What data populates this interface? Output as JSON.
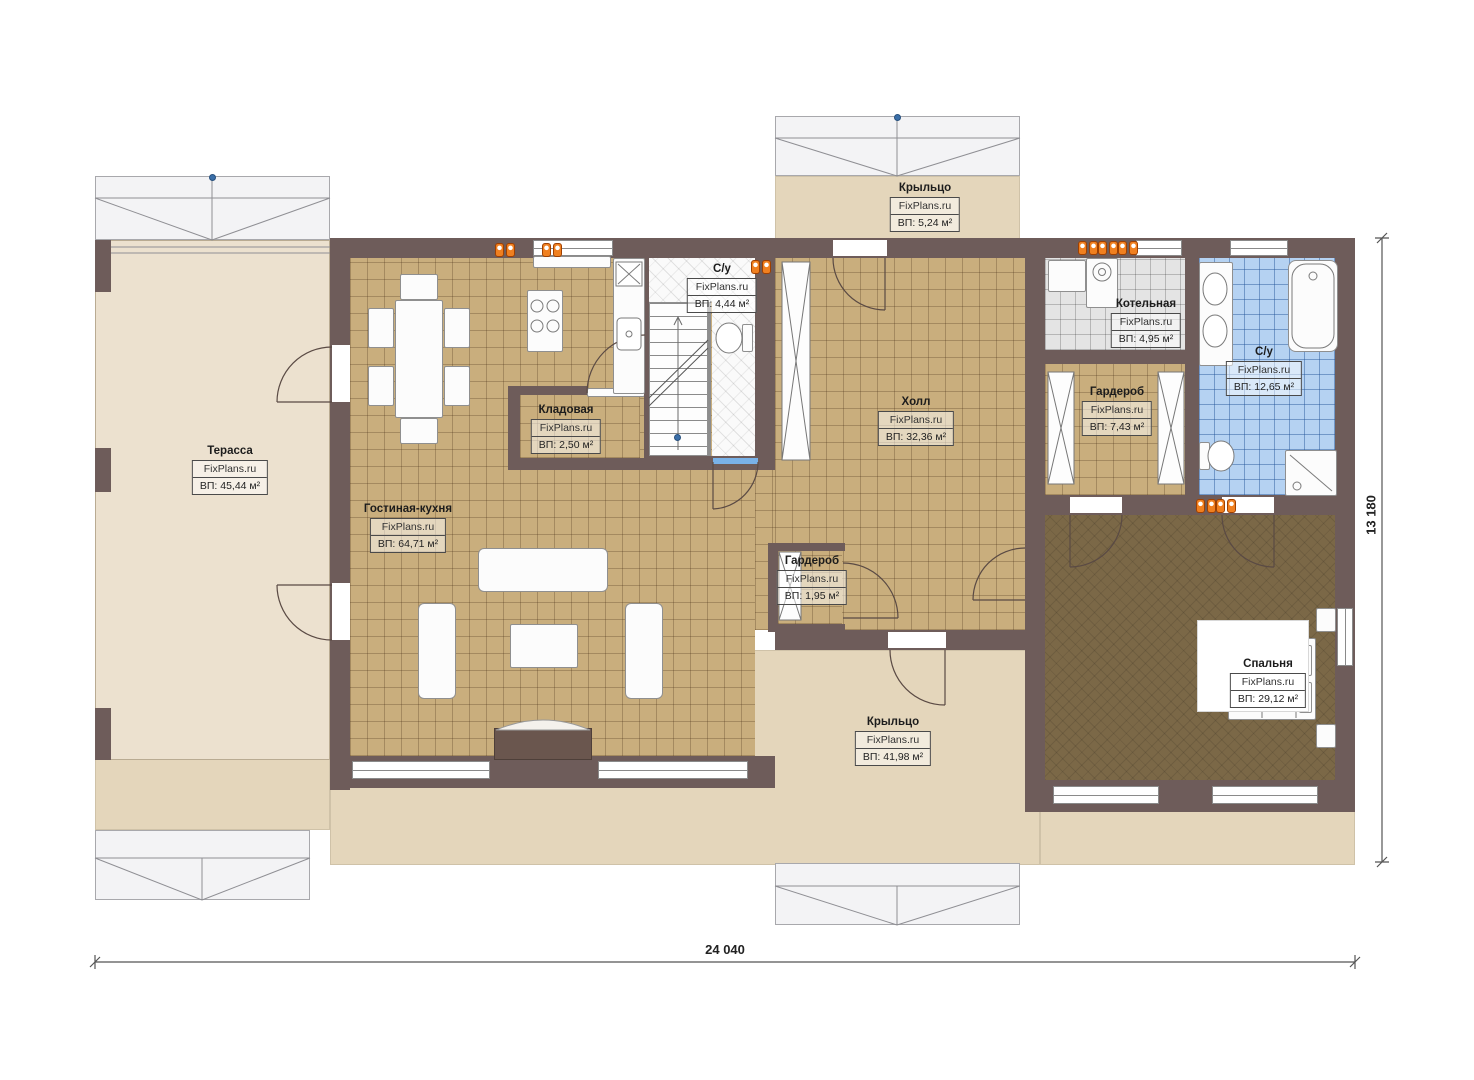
{
  "plan": {
    "watermark": "FixPlans.ru",
    "rooms": [
      {
        "name": "Терасса",
        "area": "ВП: 45,44 м²"
      },
      {
        "name": "Гостиная-кухня",
        "area": "ВП: 64,71 м²"
      },
      {
        "name": "Кладовая",
        "area": "ВП: 2,50 м²"
      },
      {
        "name": "С/у",
        "area": "ВП: 4,44 м²"
      },
      {
        "name": "Крыльцо",
        "area": "ВП: 5,24 м²"
      },
      {
        "name": "Холл",
        "area": "ВП: 32,36 м²"
      },
      {
        "name": "Котельная",
        "area": "ВП: 4,95 м²"
      },
      {
        "name": "С/у",
        "area": "ВП: 12,65 м²"
      },
      {
        "name": "Гардероб",
        "area": "ВП: 7,43 м²"
      },
      {
        "name": "Гардероб",
        "area": "ВП: 1,95 м²"
      },
      {
        "name": "Спальня",
        "area": "ВП: 29,12 м²"
      },
      {
        "name": "Крыльцо",
        "area": "ВП: 41,98 м²"
      }
    ],
    "dimensions": {
      "width_label": "24 040",
      "height_label": "13 180"
    },
    "colors": {
      "wall": "#6e5c5a",
      "tile_tan": "#c9ae7d",
      "tile_blue": "#b5d2f2",
      "tile_gray": "#e4e4e4",
      "bedroom_floor": "#7b6847",
      "porch": "#e4d6bb",
      "terrace": "#ece1cf",
      "radiator": "#f08020",
      "roof": "#f3f3f5"
    }
  }
}
